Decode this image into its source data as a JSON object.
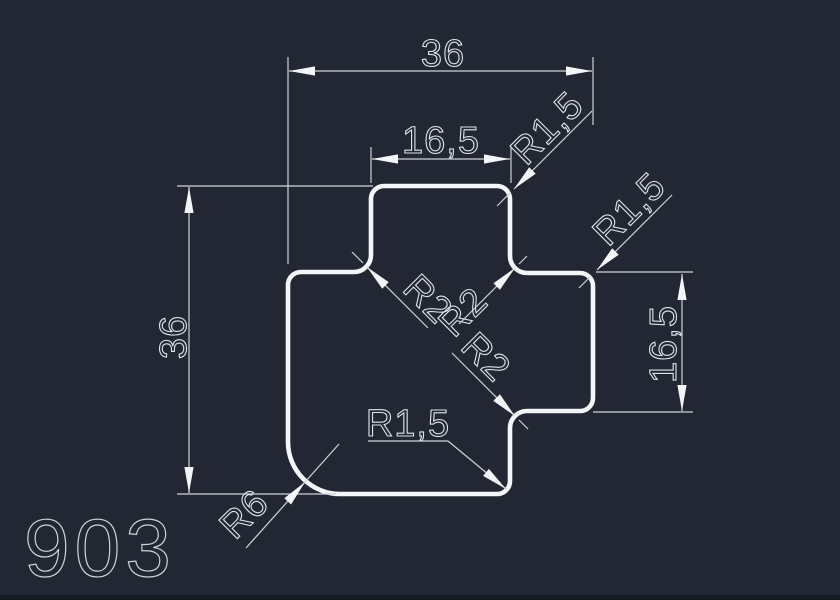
{
  "canvas": {
    "background": "#222733",
    "outline_color": "#f3f5f7",
    "dim_color": "#cdd3da",
    "text_color": "#dde2e8"
  },
  "drawing": {
    "number": "903",
    "type": "profile-cross-section"
  },
  "dimensions": {
    "overall_width": "36",
    "top_tab_width": "16,5",
    "overall_height": "36",
    "right_tab_height": "16,5"
  },
  "radius_labels": {
    "top_tab_corner": "R1,5",
    "right_tab_corner": "R1,5",
    "bottom_right_corner": "R1,5",
    "inner_fillet_left": "R2",
    "inner_fillet_top_right": "R2",
    "inner_fillet_bottom_right": "R2",
    "bottom_left_corner": "R6"
  }
}
